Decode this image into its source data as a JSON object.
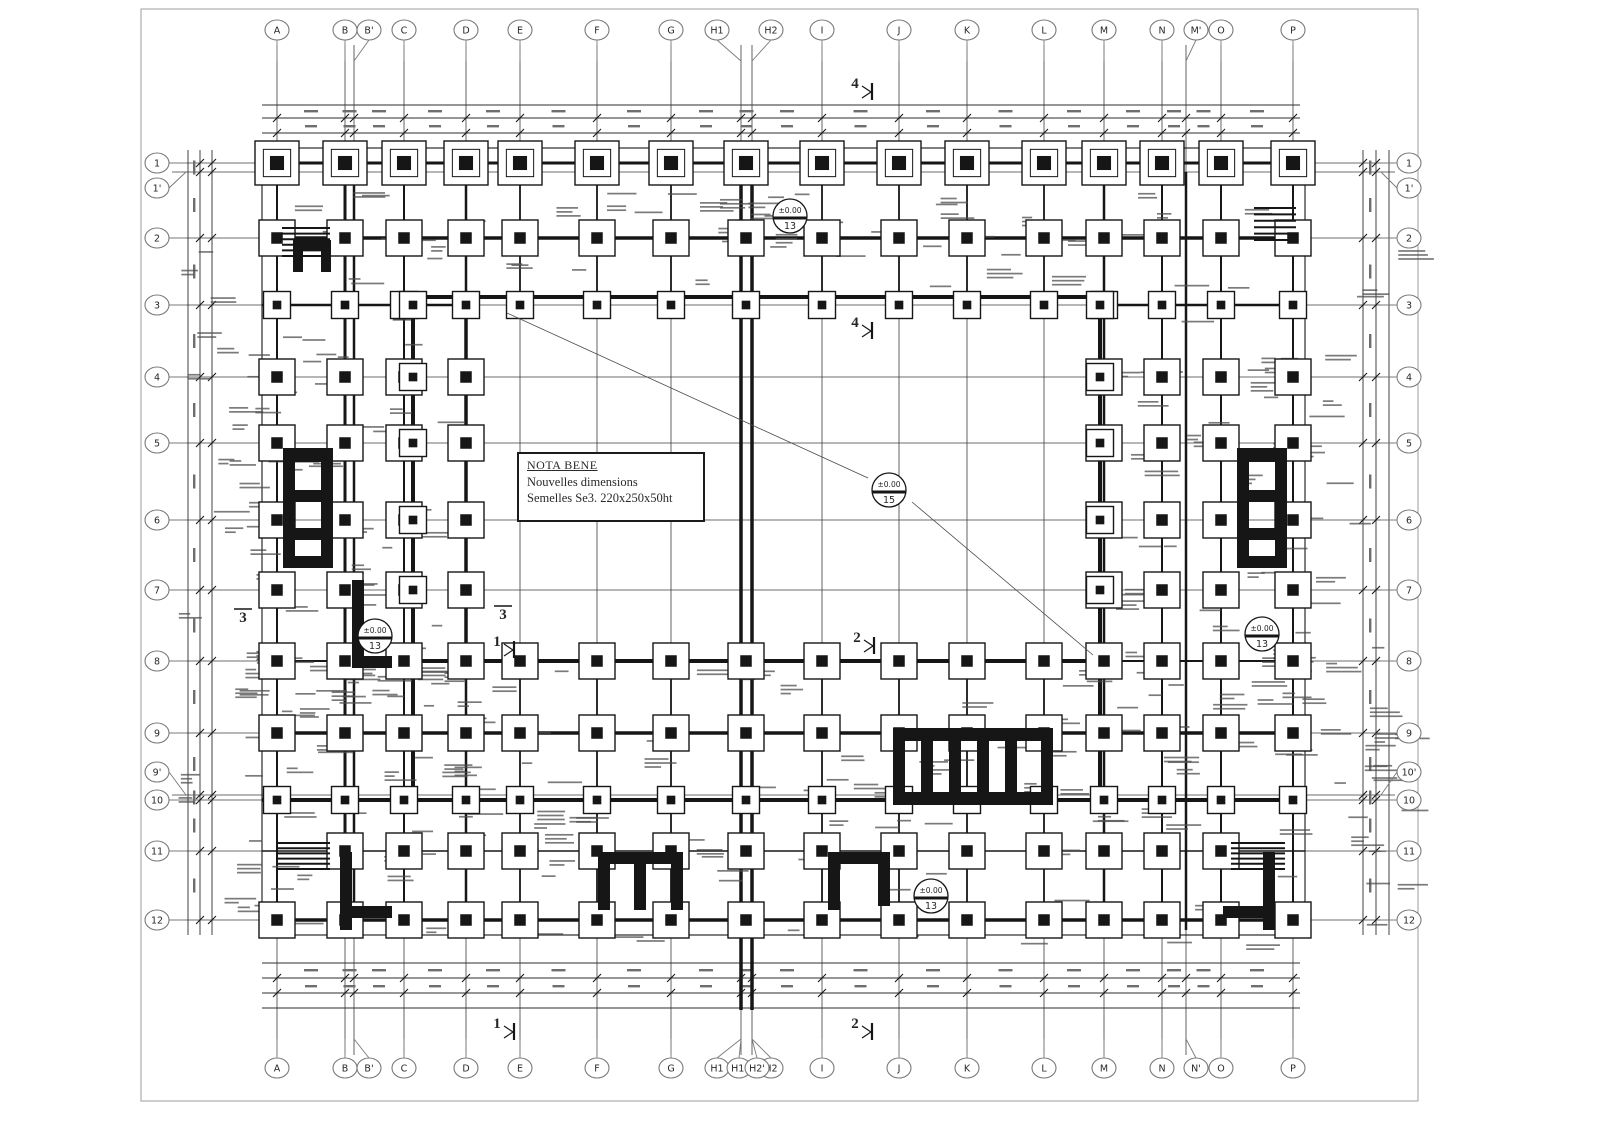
{
  "colors": {
    "ink": "#161616",
    "soft": "#555555",
    "bubble": "#7a7a7a",
    "noise": "#4d4d4d",
    "frame": "#aeaeae",
    "bg": "#ffffff"
  },
  "note_box": {
    "title": "NOTA BENE",
    "line1": "Nouvelles dimensions",
    "line2": "Semelles Se3. 220x250x50ht"
  },
  "grid": {
    "cols": [
      {
        "label": "A",
        "cx": 277
      },
      {
        "label": "B",
        "cx": 345
      },
      {
        "label": "B'",
        "cx": 369,
        "lx": 354,
        "foot": false
      },
      {
        "label": "C",
        "cx": 404
      },
      {
        "label": "D",
        "cx": 466
      },
      {
        "label": "E",
        "cx": 520
      },
      {
        "label": "F",
        "cx": 597
      },
      {
        "label": "G",
        "cx": 671
      },
      {
        "label": "H1",
        "cx": 717,
        "lx": 741,
        "fx": 746
      },
      {
        "label": "H2",
        "cx": 771,
        "lx": 752,
        "foot": false
      },
      {
        "label": "I",
        "cx": 822
      },
      {
        "label": "J",
        "cx": 899
      },
      {
        "label": "K",
        "cx": 967
      },
      {
        "label": "L",
        "cx": 1044
      },
      {
        "label": "M",
        "cx": 1104
      },
      {
        "label": "N",
        "cx": 1162
      },
      {
        "label": "M'",
        "cx": 1196,
        "lx": 1186,
        "foot": false,
        "bottom_label": "N'"
      },
      {
        "label": "O",
        "cx": 1221
      },
      {
        "label": "P",
        "cx": 1293
      }
    ],
    "bottom_extra_bubbles": [
      {
        "label": "H1'",
        "cx": 739,
        "to": 741
      },
      {
        "label": "H2'",
        "cx": 757,
        "to": 752
      }
    ],
    "rows": [
      {
        "label": "1",
        "cy": 163
      },
      {
        "label": "1'",
        "cy": 188,
        "ly": 172
      },
      {
        "label": "2",
        "cy": 238
      },
      {
        "label": "3",
        "cy": 305
      },
      {
        "label": "4",
        "cy": 377
      },
      {
        "label": "5",
        "cy": 443
      },
      {
        "label": "6",
        "cy": 520
      },
      {
        "label": "7",
        "cy": 590
      },
      {
        "label": "8",
        "cy": 661
      },
      {
        "label": "9",
        "cy": 733
      },
      {
        "label": "9'",
        "cy": 772,
        "ly": 795,
        "right_label": "10'"
      },
      {
        "label": "10",
        "cy": 800
      },
      {
        "label": "11",
        "cy": 851
      },
      {
        "label": "12",
        "cy": 920
      }
    ],
    "top_cy": 30,
    "bottom_cy": 1068,
    "left_cx": 157,
    "right_cx": 1409,
    "vline_y1": 45,
    "vline_y2": 1055,
    "hline_x1": 172,
    "hline_x2": 1395
  },
  "outline": {
    "x": 262,
    "y": 148,
    "w": 1043,
    "h": 787
  },
  "frame": {
    "x": 141,
    "y": 9,
    "w": 1277,
    "h": 1092
  },
  "walls": [
    [
      262,
      163,
      1305,
      163,
      3
    ],
    [
      262,
      238,
      1305,
      238,
      3.5
    ],
    [
      262,
      305,
      470,
      305,
      2.5
    ],
    [
      1100,
      305,
      1305,
      305,
      2.5
    ],
    [
      413,
      297,
      1100,
      297,
      4
    ],
    [
      413,
      661,
      1104,
      661,
      4
    ],
    [
      262,
      661,
      413,
      661,
      2
    ],
    [
      1104,
      661,
      1305,
      661,
      2
    ],
    [
      262,
      733,
      1305,
      733,
      3.5
    ],
    [
      262,
      800,
      1305,
      800,
      4
    ],
    [
      262,
      851,
      1305,
      851,
      1.6
    ],
    [
      262,
      920,
      1305,
      920,
      3.5
    ],
    [
      277,
      150,
      277,
      935,
      2
    ],
    [
      345,
      150,
      345,
      935,
      3
    ],
    [
      354,
      172,
      354,
      930,
      2.5
    ],
    [
      404,
      150,
      404,
      935,
      2
    ],
    [
      413,
      297,
      413,
      800,
      4
    ],
    [
      466,
      150,
      466,
      935,
      2.5
    ],
    [
      466,
      300,
      466,
      661,
      3.5
    ],
    [
      520,
      150,
      520,
      305,
      1.8
    ],
    [
      520,
      655,
      520,
      935,
      1.8
    ],
    [
      597,
      150,
      597,
      305,
      1.8
    ],
    [
      597,
      655,
      597,
      935,
      1.8
    ],
    [
      671,
      150,
      671,
      305,
      1.8
    ],
    [
      671,
      655,
      671,
      935,
      1.8
    ],
    [
      741,
      148,
      741,
      1010,
      3.5
    ],
    [
      752,
      148,
      752,
      1010,
      3.5
    ],
    [
      822,
      150,
      822,
      305,
      1.8
    ],
    [
      822,
      655,
      822,
      935,
      1.8
    ],
    [
      899,
      150,
      899,
      305,
      1.8
    ],
    [
      899,
      655,
      899,
      935,
      1.8
    ],
    [
      967,
      150,
      967,
      305,
      1.8
    ],
    [
      967,
      655,
      967,
      935,
      1.8
    ],
    [
      1044,
      150,
      1044,
      305,
      1.8
    ],
    [
      1044,
      655,
      1044,
      935,
      1.8
    ],
    [
      1100,
      297,
      1100,
      800,
      4
    ],
    [
      1104,
      150,
      1104,
      935,
      2.5
    ],
    [
      1162,
      150,
      1162,
      935,
      2
    ],
    [
      1186,
      172,
      1186,
      930,
      2.5
    ],
    [
      1221,
      150,
      1221,
      935,
      2
    ],
    [
      1293,
      150,
      1293,
      935,
      2
    ]
  ],
  "footings": {
    "sizes": {
      "L": 44,
      "M": 36,
      "S": 27
    },
    "rows": [
      {
        "y": 163,
        "set": "all",
        "size": "L"
      },
      {
        "y": 238,
        "set": "all",
        "size": "M"
      },
      {
        "y": 305,
        "set": "all",
        "size": "S"
      },
      {
        "y": 377,
        "set": "wings",
        "size": "M"
      },
      {
        "y": 443,
        "set": "wings",
        "size": "M"
      },
      {
        "y": 520,
        "set": "wings",
        "size": "M"
      },
      {
        "y": 590,
        "set": "wings",
        "size": "M"
      },
      {
        "y": 661,
        "set": "all",
        "size": "M"
      },
      {
        "y": 733,
        "set": "all",
        "size": "M"
      },
      {
        "y": 800,
        "set": "all",
        "size": "S"
      },
      {
        "y": 851,
        "set": "mid",
        "size": "M"
      },
      {
        "y": 920,
        "set": "all",
        "size": "M"
      }
    ],
    "wing_labels": [
      "A",
      "B",
      "C",
      "D",
      "M",
      "N",
      "O",
      "P"
    ],
    "mid_exclude": [
      "A",
      "P"
    ],
    "inner_edge_x": [
      413,
      1100
    ],
    "inner_edge_rows": [
      305,
      377,
      443,
      520,
      590
    ],
    "inner_edge_size": "S"
  },
  "cores": [
    [
      283,
      448,
      12,
      120
    ],
    [
      321,
      448,
      12,
      120
    ],
    [
      295,
      448,
      26,
      14
    ],
    [
      295,
      490,
      26,
      12
    ],
    [
      295,
      528,
      26,
      12
    ],
    [
      295,
      556,
      26,
      12
    ],
    [
      1237,
      448,
      12,
      120
    ],
    [
      1275,
      448,
      12,
      120
    ],
    [
      1249,
      448,
      26,
      14
    ],
    [
      1249,
      490,
      26,
      12
    ],
    [
      1249,
      528,
      26,
      12
    ],
    [
      1249,
      556,
      26,
      12
    ],
    [
      893,
      728,
      160,
      13
    ],
    [
      893,
      792,
      160,
      13
    ],
    [
      893,
      740,
      12,
      52
    ],
    [
      921,
      740,
      12,
      52
    ],
    [
      949,
      740,
      12,
      52
    ],
    [
      977,
      740,
      12,
      52
    ],
    [
      1005,
      740,
      12,
      52
    ],
    [
      1041,
      740,
      12,
      52
    ],
    [
      340,
      852,
      12,
      78
    ],
    [
      340,
      906,
      52,
      12
    ],
    [
      598,
      852,
      85,
      12
    ],
    [
      598,
      864,
      12,
      46
    ],
    [
      634,
      864,
      12,
      46
    ],
    [
      671,
      864,
      12,
      46
    ],
    [
      828,
      852,
      62,
      12
    ],
    [
      828,
      864,
      12,
      46
    ],
    [
      878,
      864,
      12,
      42
    ],
    [
      1263,
      852,
      12,
      78
    ],
    [
      1223,
      906,
      52,
      12
    ],
    [
      352,
      580,
      12,
      88
    ],
    [
      352,
      656,
      40,
      12
    ],
    [
      293,
      240,
      38,
      10
    ],
    [
      293,
      250,
      10,
      22
    ],
    [
      321,
      250,
      10,
      22
    ]
  ],
  "stair_hatches": [
    [
      282,
      228,
      48,
      28
    ],
    [
      1254,
      208,
      42,
      32
    ],
    [
      278,
      843,
      52,
      26
    ],
    [
      1231,
      843,
      54,
      26
    ]
  ],
  "dims": {
    "top": [
      {
        "y": 105
      },
      {
        "y": 118,
        "ticks": true
      },
      {
        "y": 133,
        "ticks": true
      }
    ],
    "bottom": [
      {
        "y": 963
      },
      {
        "y": 978,
        "ticks": true
      },
      {
        "y": 993,
        "ticks": true
      },
      {
        "y": 1008
      }
    ],
    "left": [
      {
        "x": 188
      },
      {
        "x": 200,
        "ticks": true
      },
      {
        "x": 212,
        "ticks": true
      }
    ],
    "right": [
      {
        "x": 1363,
        "ticks": true
      },
      {
        "x": 1376,
        "ticks": true
      },
      {
        "x": 1389
      }
    ],
    "h_x1": 262,
    "h_x2": 1300,
    "v_y1": 150,
    "v_y2": 935
  },
  "level_markers": [
    {
      "x": 790,
      "y": 216,
      "value": "±0.00",
      "num": "13"
    },
    {
      "x": 889,
      "y": 490,
      "value": "±0.00",
      "num": "15"
    },
    {
      "x": 375,
      "y": 636,
      "value": "±0.00",
      "num": "13"
    },
    {
      "x": 1262,
      "y": 634,
      "value": "±0.00",
      "num": "13"
    },
    {
      "x": 931,
      "y": 896,
      "value": "±0.00",
      "num": "13"
    }
  ],
  "section_markers": [
    {
      "x": 855,
      "y": 88,
      "label": "4",
      "type": "flag"
    },
    {
      "x": 855,
      "y": 327,
      "label": "4",
      "type": "flag"
    },
    {
      "x": 857,
      "y": 642,
      "label": "2",
      "type": "flag"
    },
    {
      "x": 497,
      "y": 646,
      "label": "1",
      "type": "flag"
    },
    {
      "x": 497,
      "y": 1028,
      "label": "1",
      "type": "flag"
    },
    {
      "x": 855,
      "y": 1028,
      "label": "2",
      "type": "flag"
    },
    {
      "x": 243,
      "y": 622,
      "label": "3",
      "type": "overline"
    },
    {
      "x": 503,
      "y": 619,
      "label": "3",
      "type": "overline"
    }
  ],
  "leaders": [
    [
      507,
      313,
      868,
      478
    ],
    [
      912,
      502,
      1093,
      655
    ]
  ],
  "noise": {
    "seed": 7,
    "regions": [
      {
        "x": 270,
        "y": 190,
        "w": 1020,
        "h": 100,
        "n": 55
      },
      {
        "x": 225,
        "y": 312,
        "w": 238,
        "h": 478,
        "n": 60
      },
      {
        "x": 1097,
        "y": 312,
        "w": 243,
        "h": 478,
        "n": 60
      },
      {
        "x": 270,
        "y": 668,
        "w": 1020,
        "h": 125,
        "n": 55
      },
      {
        "x": 270,
        "y": 808,
        "w": 1020,
        "h": 138,
        "n": 60
      },
      {
        "x": 176,
        "y": 250,
        "w": 84,
        "h": 675,
        "n": 26
      },
      {
        "x": 1344,
        "y": 250,
        "w": 58,
        "h": 675,
        "n": 20
      }
    ]
  }
}
